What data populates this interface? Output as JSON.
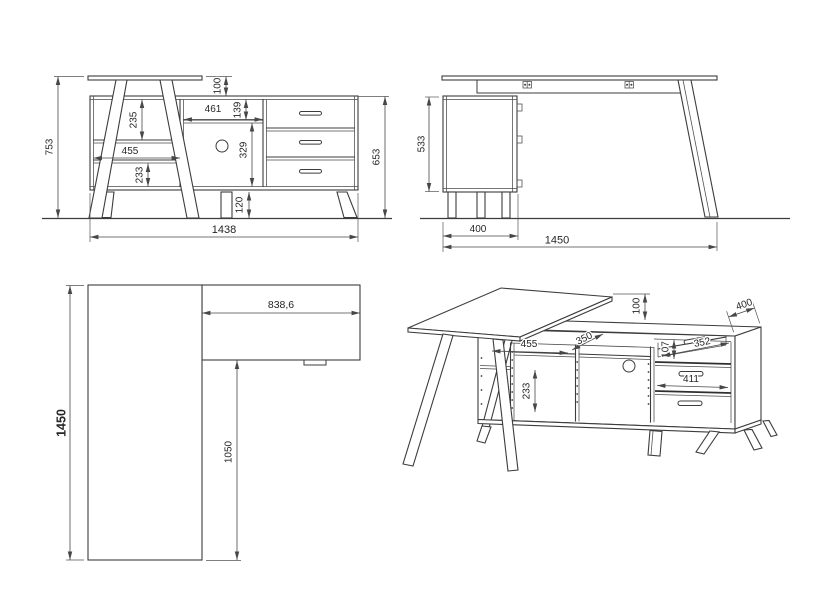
{
  "drawing": {
    "background": "#ffffff",
    "ink": "#3c3c3c",
    "views": {
      "front": {
        "name": "front-elevation",
        "dims": {
          "total_height": "753",
          "desk_overhang": "100",
          "shelf_gap_top": "235",
          "compartment_width": "455",
          "shelf_gap_bottom": "233",
          "niche_width": "461",
          "niche_height": "139",
          "panel_height": "329",
          "plinth_height": "120",
          "cabinet_height": "653",
          "total_width": "1438"
        }
      },
      "side": {
        "name": "side-elevation",
        "dims": {
          "cabinet_height": "533",
          "cabinet_depth": "400",
          "total_depth": "1450"
        }
      },
      "plan": {
        "name": "top-plan-view",
        "dims": {
          "total_depth": "1450",
          "sideboard_length": "838,6",
          "desk_clear_depth": "1050"
        }
      },
      "perspective": {
        "name": "perspective-view",
        "dims": {
          "desk_overhang": "100",
          "cabinet_depth": "400",
          "shelf_depth": "350",
          "compartment_width": "455",
          "shelf_gap_bottom": "233",
          "drawer_inner_height": "107",
          "drawer_inner_depth": "352",
          "drawer_inner_width": "411"
        }
      }
    }
  }
}
